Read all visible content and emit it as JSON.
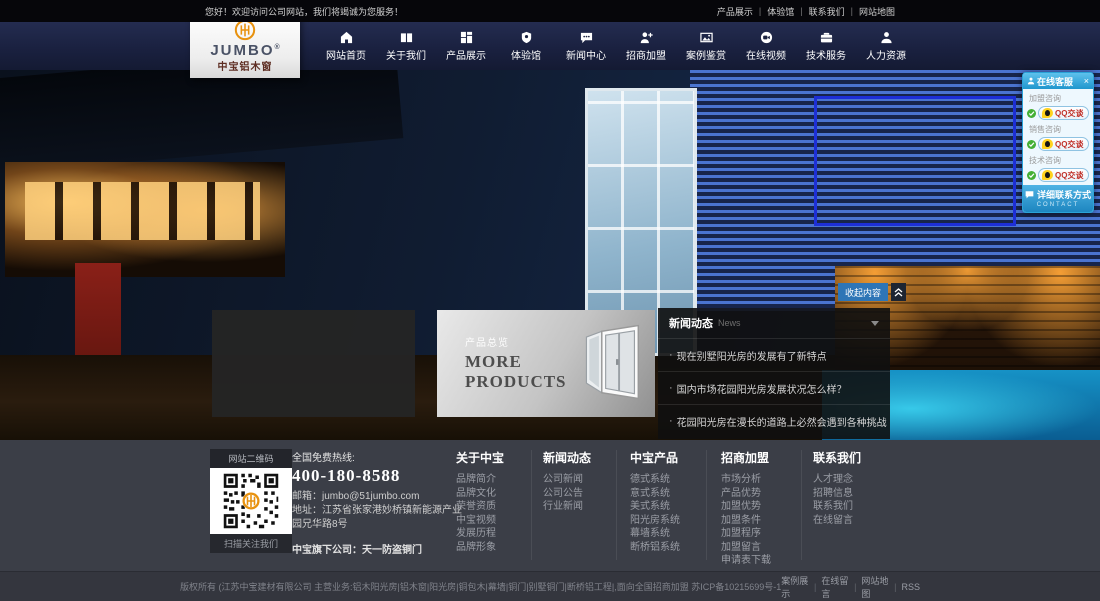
{
  "topbar": {
    "welcome": "您好！欢迎访问公司网站，我们将竭诚为您服务！",
    "sep": "|",
    "links": [
      "产品展示",
      "体验馆",
      "联系我们",
      "网站地图"
    ]
  },
  "logo": {
    "name": "JUMBO",
    "reg": "®",
    "subtitle": "中宝铝木窗"
  },
  "nav": {
    "items": [
      {
        "label": "网站首页"
      },
      {
        "label": "关于我们"
      },
      {
        "label": "产品展示"
      },
      {
        "label": "体验馆"
      },
      {
        "label": "新闻中心"
      },
      {
        "label": "招商加盟"
      },
      {
        "label": "案例鉴赏"
      },
      {
        "label": "在线视频"
      },
      {
        "label": "技术服务"
      },
      {
        "label": "人力资源"
      }
    ]
  },
  "qq_panel": {
    "title": "在线客服",
    "close": "×",
    "groups": [
      {
        "label": "加盟咨询",
        "button": "QQ交谈"
      },
      {
        "label": "销售咨询",
        "button": "QQ交谈"
      },
      {
        "label": "技术咨询",
        "button": "QQ交谈"
      }
    ],
    "footer_label": "详细联系方式",
    "footer_sub": "CONTACT"
  },
  "hero": {
    "collapse_label": "收起内容"
  },
  "products": {
    "tag": "产品总览",
    "title_line1": "MORE",
    "title_line2": "PRODUCTS"
  },
  "news": {
    "title": "新闻动态",
    "subtitle": "News",
    "bullet": "·",
    "items": [
      "现在别墅阳光房的发展有了新特点",
      "国内市场花园阳光房发展状况怎么样？",
      "花园阳光房在漫长的道路上必然会遇到各种挑战"
    ]
  },
  "footer": {
    "qr": {
      "top": "网站二维码",
      "bottom": "扫描关注我们"
    },
    "contact": {
      "hotline_label": "全国免费热线:",
      "hotline": "400-180-8588",
      "email_label": "邮箱：",
      "email": "jumbo@51jumbo.com",
      "address_label": "地址：",
      "address": "江苏省张家港妙桥镇新能源产业园兄华路8号",
      "subsidiary": "中宝旗下公司：天一防盗铜门"
    },
    "columns": [
      {
        "title": "关于中宝",
        "links": [
          "品牌简介",
          "品牌文化",
          "荣誉资质",
          "中宝视频",
          "发展历程",
          "品牌形象"
        ]
      },
      {
        "title": "新闻动态",
        "links": [
          "公司新闻",
          "公司公告",
          "行业新闻"
        ]
      },
      {
        "title": "中宝产品",
        "links": [
          "德式系统",
          "意式系统",
          "美式系统",
          "阳光房系统",
          "幕墙系统",
          "断桥铝系统"
        ]
      },
      {
        "title": "招商加盟",
        "links": [
          "市场分析",
          "产品优势",
          "加盟优势",
          "加盟条件",
          "加盟程序",
          "加盟留言",
          "申请表下载"
        ]
      },
      {
        "title": "联系我们",
        "links": [
          "人才理念",
          "招聘信息",
          "联系我们",
          "在线留言"
        ]
      }
    ]
  },
  "bottombar": {
    "copyright": "版权所有 (江苏中宝建材有限公司 主营业务:铝木阳光房|铝木窗|阳光房|铜包木|幕墙|铜门|别墅铜门|断桥铝工程|,面向全国招商加盟 苏ICP备10215699号-1",
    "sep": "|",
    "links": [
      "案例展示",
      "在线留言",
      "网站地图",
      "RSS"
    ]
  },
  "colors": {
    "accent_blue": "#2e75b6",
    "nav_bg": "#1b2240",
    "qq_blue": "#2aa3d8",
    "footer_bg": "#3b3e47",
    "logo_orange": "#e8920f",
    "selection_blue": "#1d2fd6"
  }
}
